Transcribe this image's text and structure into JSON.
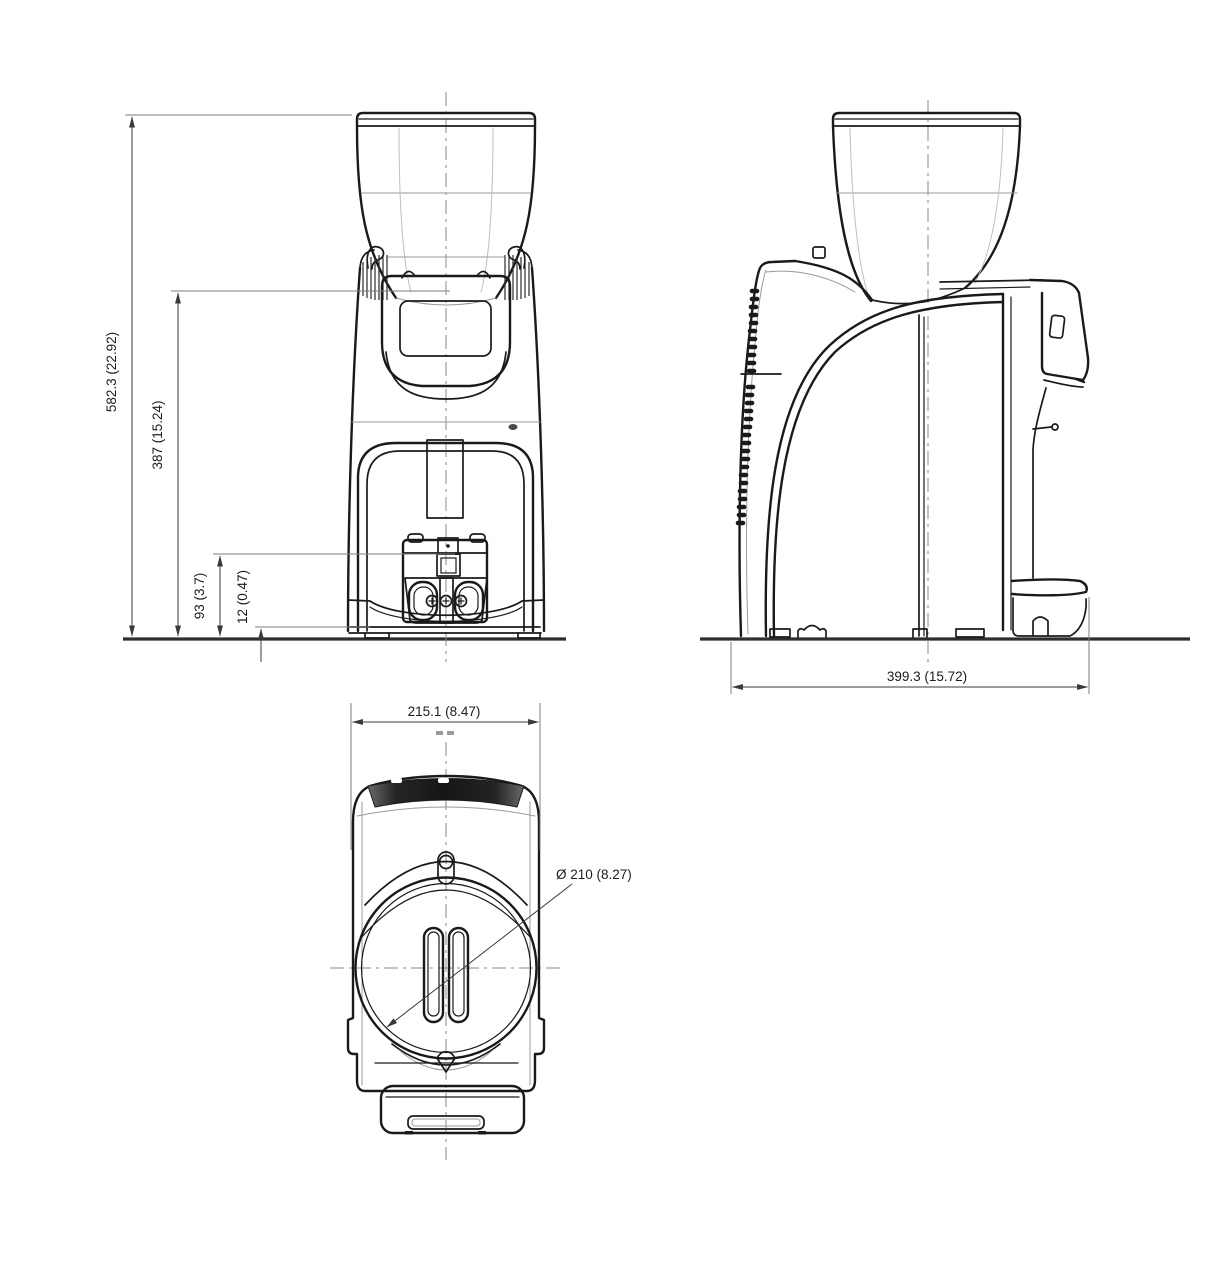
{
  "drawing": {
    "type": "technical-dimension-drawing",
    "subject": "coffee-grinder-three-views",
    "views": [
      "front",
      "side",
      "top"
    ],
    "dimensions": {
      "overall_height": "582.3 (22.92)",
      "height_to_display_top": "387 (15.24)",
      "spout_clearance_height": "93 (3.7)",
      "tray_lip_height": "12 (0.47)",
      "overall_depth": "399.3 (15.72)",
      "overall_width": "215.1 (8.47)",
      "hopper_diameter": "Ø  210 (8.27)"
    },
    "colors": {
      "line": "#1a1a1a",
      "dim": "#3a3a3a",
      "light": "#9a9a9a",
      "centerline": "#8a8a8a",
      "ground": "#2e2e2e",
      "text": "#1c1c1c",
      "band": "#1e1e1e",
      "bg": "#ffffff"
    }
  }
}
